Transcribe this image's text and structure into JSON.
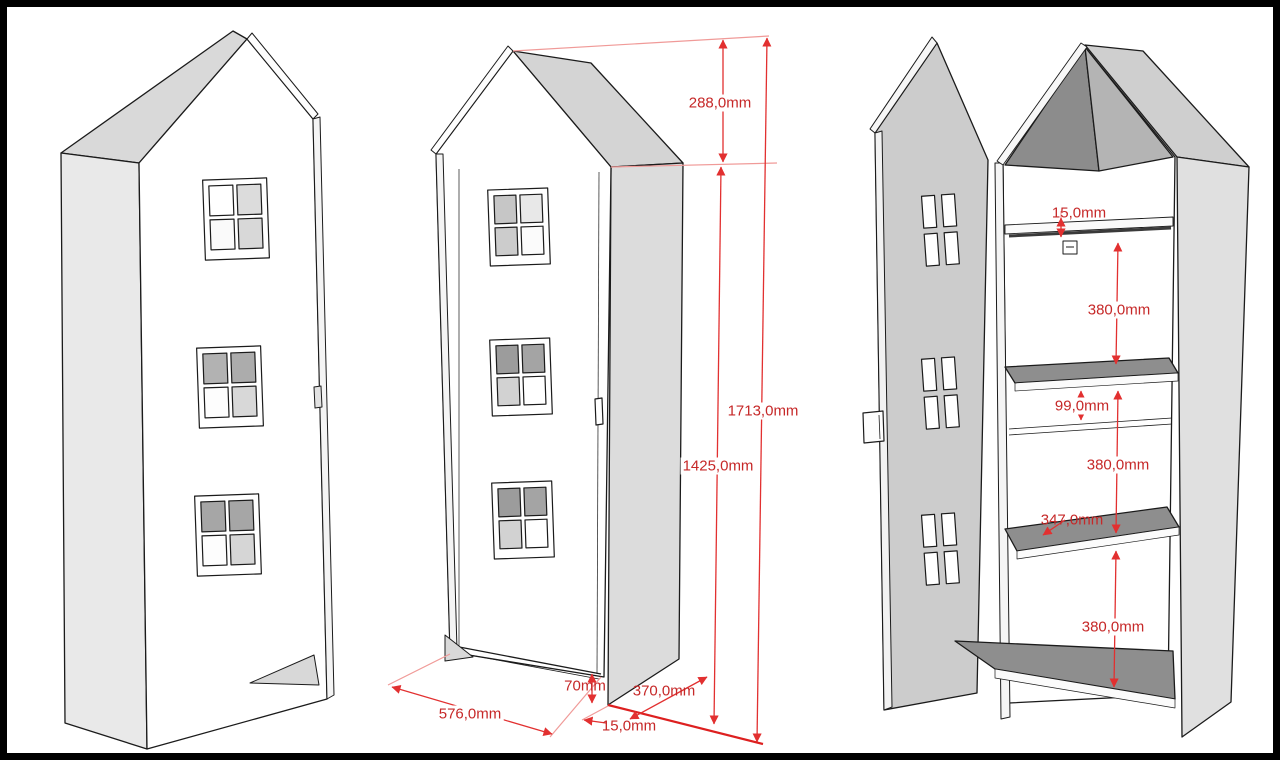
{
  "drawing": {
    "type": "furniture technical drawing",
    "subject": "house-shaped kids wardrobe, three views",
    "views": {
      "left": "perspective view, door closed",
      "middle": "front perspective view with overall dimensions",
      "right": "open view showing shelves and interior dimensions"
    }
  },
  "colors": {
    "dimension_line_red": "#e23030",
    "dimension_text_red": "#c62828",
    "panel_gray": "#e0e0e0",
    "roof_gray": "#d4d4d4",
    "shelf_top_gray": "#8e8e8e",
    "outline_black": "#1b1b1b"
  },
  "dims": {
    "middle": {
      "roof_height": "288,0mm",
      "total_height": "1713,0mm",
      "body_height": "1425,0mm",
      "bottom_gap": "70mm",
      "width": "576,0mm",
      "side_thickness": "15,0mm",
      "depth": "370,0mm"
    },
    "right": {
      "top_shelf_thickness": "15,0mm",
      "top_section": "380,0mm",
      "rail_gap": "99,0mm",
      "middle_section": "380,0mm",
      "shelf_depth": "347,0mm",
      "bottom_section": "380,0mm"
    }
  }
}
